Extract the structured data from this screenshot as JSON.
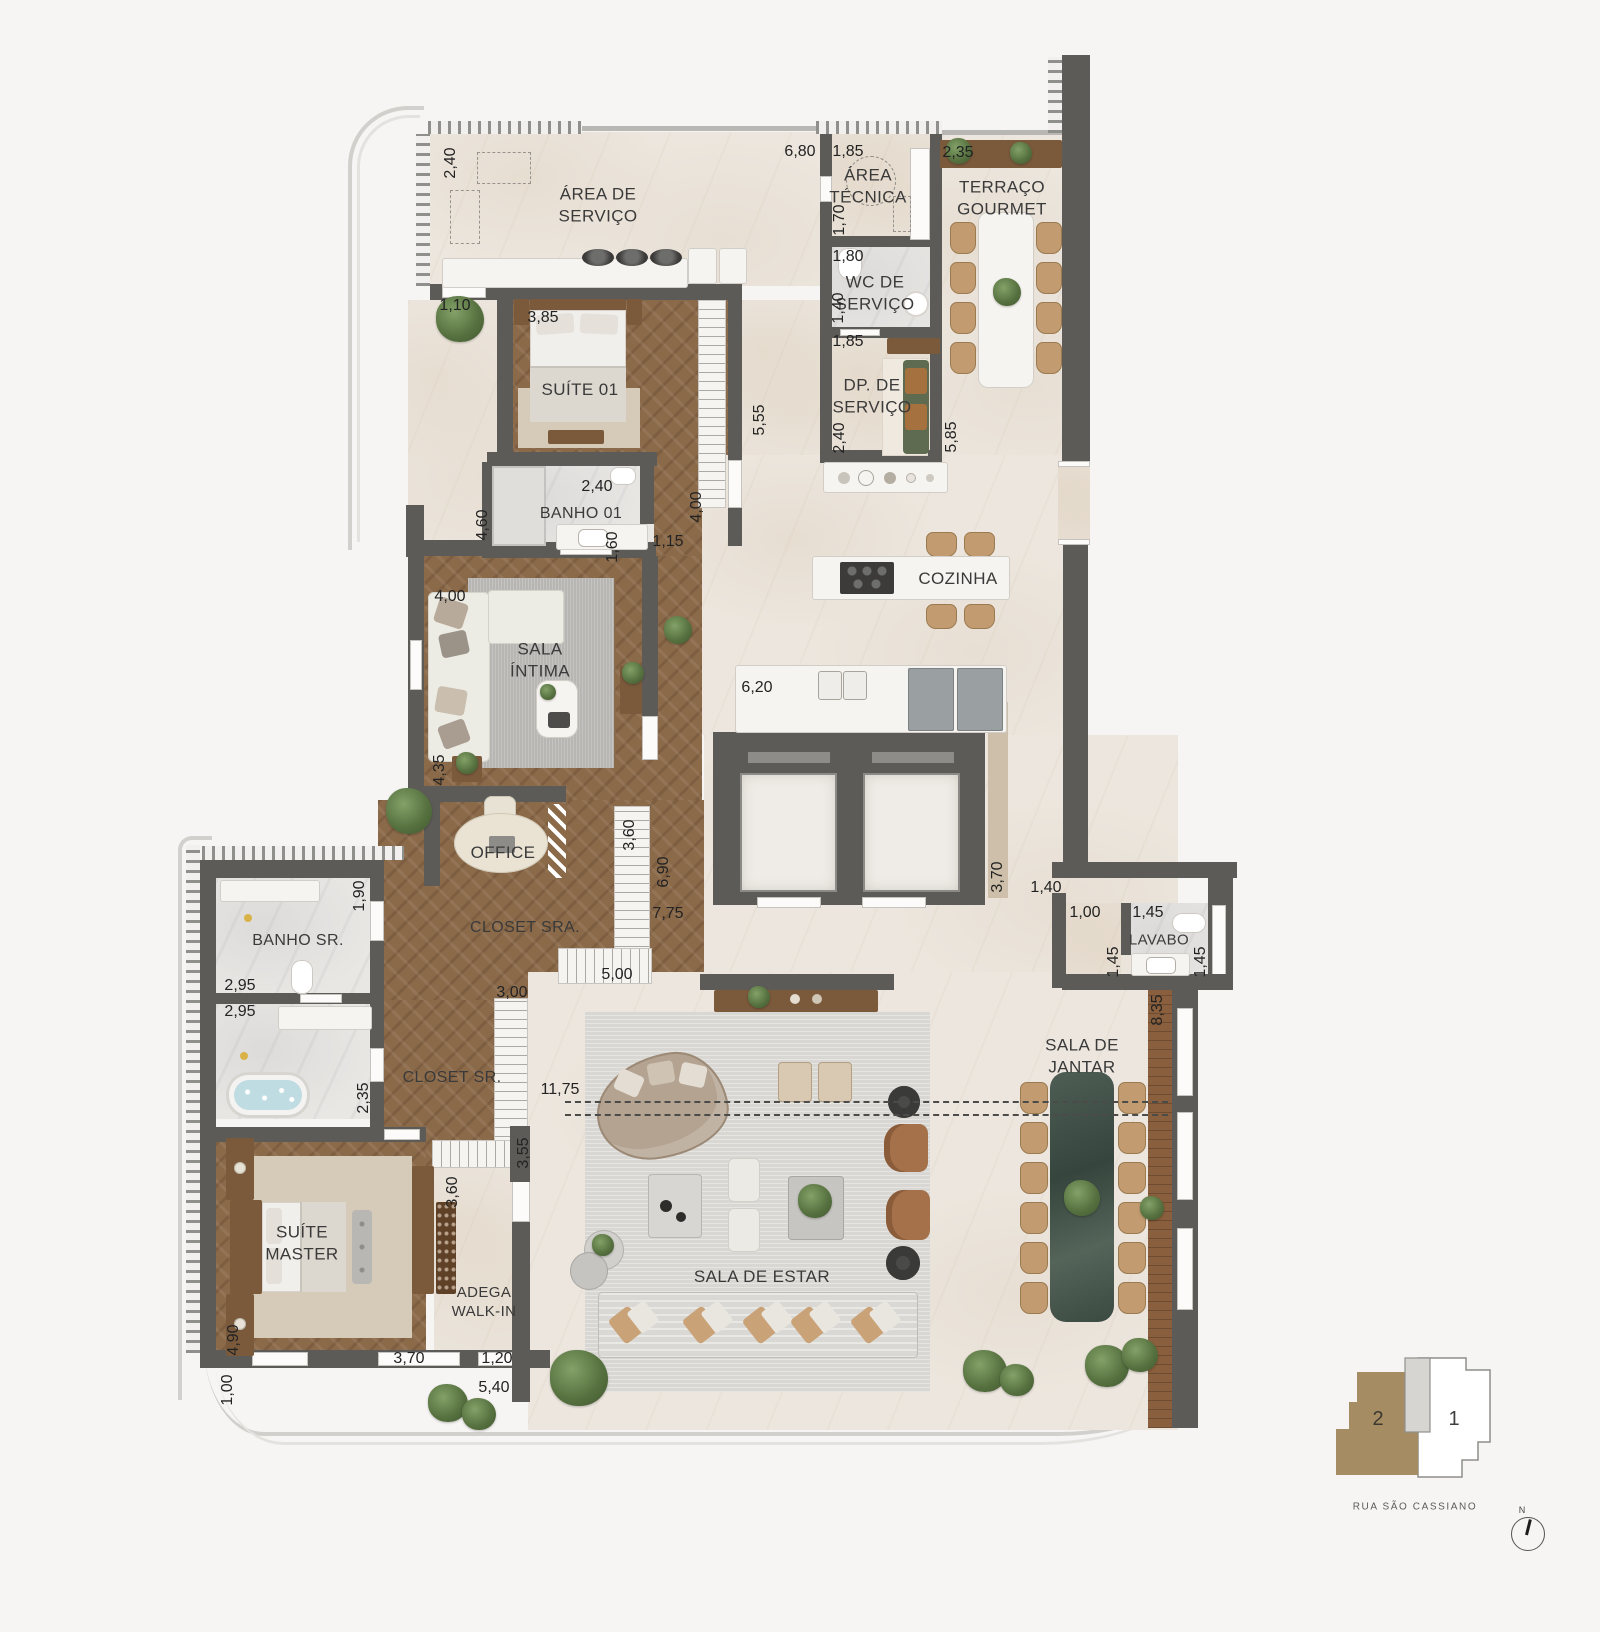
{
  "rooms": {
    "area_servico": "ÁREA DE\nSERVIÇO",
    "area_tecnica": "ÁREA\nTÉCNICA",
    "terraco_gourmet": "TERRAÇO\nGOURMET",
    "wc_servico": "WC DE\nSERVIÇO",
    "dp_servico": "DP. DE\nSERVIÇO",
    "suite_01": "SUÍTE 01",
    "banho_01": "BANHO 01",
    "cozinha": "COZINHA",
    "sala_intima": "SALA\nÍNTIMA",
    "office": "OFFICE",
    "closet_sra": "CLOSET SRA.",
    "closet_sr": "CLOSET SR.",
    "banho_sr": "BANHO SR.",
    "suite_master": "SUÍTE\nMASTER",
    "adega": "ADEGA\nWALK-IN",
    "sala_estar": "SALA DE ESTAR",
    "sala_jantar": "SALA DE\nJANTAR",
    "lavabo": "LAVABO"
  },
  "dims": {
    "d01": "2,40",
    "d02": "6,80",
    "d03": "1,85",
    "d04": "2,35",
    "d05": "1,70",
    "d06": "1,80",
    "d07": "1,40",
    "d08": "1,85",
    "d09": "2,40",
    "d10": "5,85",
    "d11": "5,55",
    "d12": "1,10",
    "d13": "3,85",
    "d14": "2,40",
    "d15": "4,60",
    "d16": "1,60",
    "d17": "1,15",
    "d18": "4,00",
    "d19": "4,00",
    "d20": "4,35",
    "d21": "6,20",
    "d22": "3,60",
    "d23": "6,90",
    "d24": "7,75",
    "d25": "5,00",
    "d26": "3,00",
    "d27": "1,90",
    "d28": "2,95",
    "d29": "2,95",
    "d30": "2,35",
    "d31": "11,75",
    "d32": "3,55",
    "d33": "3,60",
    "d34": "4,90",
    "d35": "3,70",
    "d36": "1,20",
    "d37": "1,00",
    "d38": "5,40",
    "d39": "3,70",
    "d40": "1,40",
    "d41": "1,00",
    "d42": "1,45",
    "d43": "1,45",
    "d44": "1,45",
    "d45": "8,35"
  },
  "keyplan": {
    "unit_1": "1",
    "unit_2": "2",
    "street": "RUA SÃO CASSIANO",
    "north_label": "N"
  }
}
